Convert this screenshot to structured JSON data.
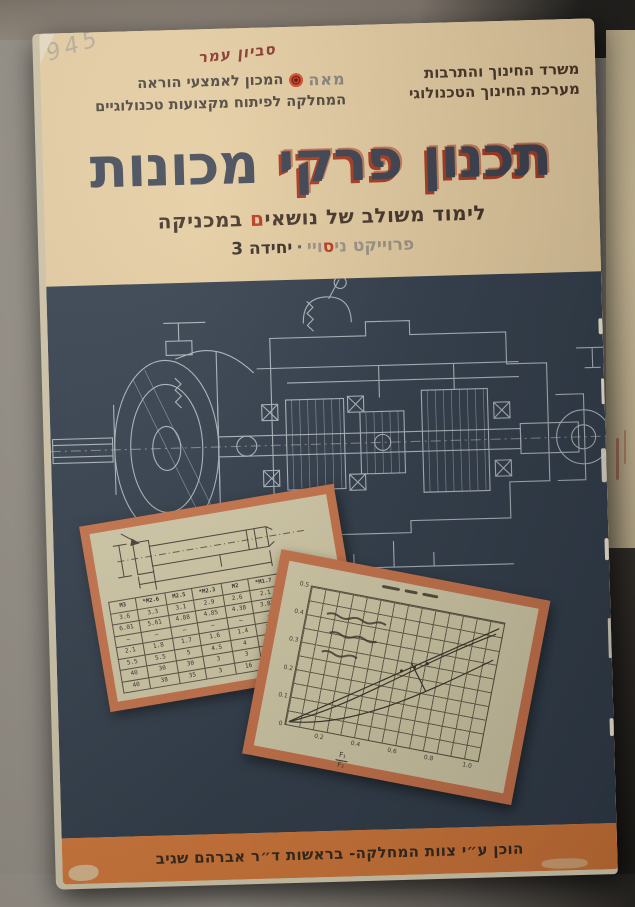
{
  "photo": {
    "handwritten_pencil": "945",
    "handwritten_ink": "סביון עמר"
  },
  "header": {
    "publisher": {
      "logo": "מאה",
      "institute": "המכון לאמצעי הוראה",
      "department": "המחלקה לפיתוח מקצועות טכנולוגיים"
    },
    "ministry": {
      "line1": "משרד החינוך והתרבות",
      "line2": "מערכת החינוך הטכנולוגי"
    }
  },
  "title": {
    "word1": "תכנון",
    "word2": "פרקי",
    "word3": "מכונות"
  },
  "subtitle": {
    "before": "לימוד משולב של נושאי",
    "red_letter": "ם",
    "after": " במכניקה"
  },
  "project": {
    "part1": "פרוייקט ני",
    "red_letter": "ס",
    "part2": "ויי",
    "dot": "·",
    "unit": "יחידה 3"
  },
  "footer": {
    "credit": "הוכן ע״י צוות המחלקה- בראשות ד״ר אברהם שגיב"
  },
  "table_card": {
    "headers": [
      "",
      "M1.6",
      "M1.7*",
      "M2",
      "M2.3*",
      "M2.5",
      "M2.6*",
      "M3"
    ],
    "rows": [
      [
        "e",
        "2",
        "2.1",
        "2.6",
        "2.9",
        "3.1",
        "3.3",
        "3.6"
      ],
      [
        "dk",
        "3.48",
        "3.82",
        "4.38",
        "4.85",
        "4.88",
        "5.61",
        "6.01"
      ],
      [
        "m",
        "–",
        "–",
        "–",
        "–",
        "–",
        "–",
        "–"
      ],
      [
        "k",
        "1.1",
        "1.3",
        "1.4",
        "1.6",
        "1.7",
        "1.8",
        "2.1"
      ],
      [
        "s",
        "3.1",
        "3.5",
        "4",
        "4.5",
        "5",
        "5.5",
        "5.5"
      ],
      [
        "t",
        "3",
        "3",
        "3",
        "3",
        "30",
        "30",
        "40"
      ],
      [
        "L",
        "12",
        "12",
        "16",
        "3",
        "35",
        "38",
        "40"
      ]
    ]
  },
  "graph_card": {
    "y_ticks": [
      "0.5",
      "0.4",
      "0.3",
      "0.2",
      "0.1",
      "0"
    ],
    "x_ticks": [
      "0.2",
      "0.4",
      "0.6",
      "0.8",
      "1.0"
    ],
    "x_fraction_top": "F₁",
    "x_fraction_bottom": "F₂"
  },
  "colors": {
    "cover_cream": "#ebd2a5",
    "panel_navy": "#34404e",
    "strip_orange": "#dd7e3d",
    "card_border": "#d0784e",
    "card_paper": "#dbd2ae",
    "title_ink": "#3d4250",
    "title_shadow_red": "#ac3a1e",
    "accent_red": "#c23a20",
    "text_brown": "#4a3526",
    "logo_gray": "#8a857c",
    "logo_red": "#cc2e1c",
    "drawing_line": "#c9d0d7"
  }
}
